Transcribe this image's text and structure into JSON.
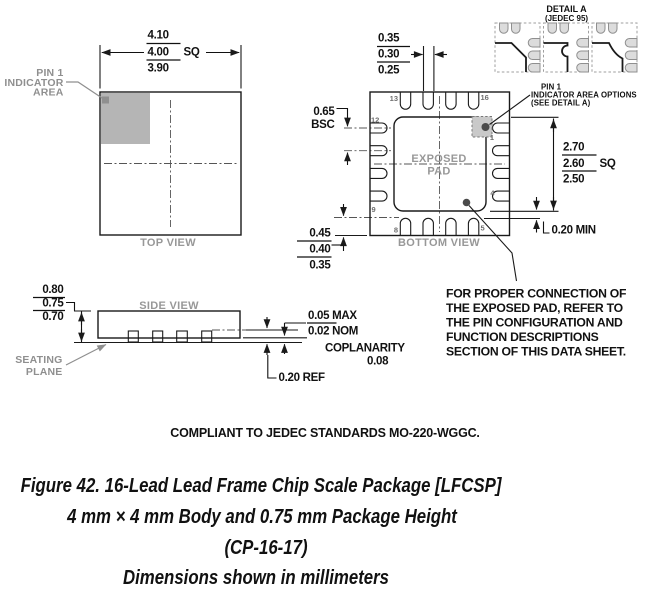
{
  "colors": {
    "ink": "#1a1a1a",
    "gray_label": "#989898",
    "pin1_area_fill": "#b5b5b5",
    "detail_pad_fill": "#dcdcdc",
    "stipple_fill": "#c9c9c9"
  },
  "top_view": {
    "title": "TOP VIEW",
    "pin1_label": [
      "PIN 1",
      "INDICATOR",
      "AREA"
    ],
    "body_dim": {
      "max": "4.10",
      "nom": "4.00",
      "suffix": "SQ",
      "min": "3.90"
    }
  },
  "bottom_view": {
    "title": "BOTTOM VIEW",
    "exposed_pad_label": [
      "EXPOSED",
      "PAD"
    ],
    "pins": {
      "top_left": "13",
      "top_right": "16",
      "left_top": "12",
      "left_bottom": "9",
      "bottom_left": "8",
      "bottom_right": "5",
      "right_top": "1",
      "right_bottom": "4"
    },
    "lead_width": {
      "max": "0.35",
      "nom": "0.30",
      "min": "0.25"
    },
    "pitch": {
      "value": "0.65",
      "qual": "BSC"
    },
    "lead_length": {
      "max": "0.45",
      "nom": "0.40",
      "min": "0.35"
    },
    "pad_dim": {
      "max": "2.70",
      "nom": "2.60",
      "suffix": "SQ",
      "min": "2.50"
    },
    "clearance": "0.20 MIN",
    "pin1_callout": [
      "PIN 1",
      "INDICATOR AREA OPTIONS",
      "(SEE DETAIL A)"
    ]
  },
  "detail_a": {
    "title": "DETAIL A",
    "subtitle": "(JEDEC 95)"
  },
  "side_view": {
    "title": "SIDE VIEW",
    "height": {
      "max": "0.80",
      "nom": "0.75",
      "min": "0.70"
    },
    "seating_plane": [
      "SEATING",
      "PLANE"
    ],
    "standoff": {
      "max": "0.05 MAX",
      "nom": "0.02 NOM"
    },
    "coplanarity": {
      "label": "COPLANARITY",
      "value": "0.08"
    },
    "lead_thickness": "0.20 REF"
  },
  "note_lines": [
    "FOR PROPER CONNECTION OF",
    "THE EXPOSED PAD, REFER TO",
    "THE PIN CONFIGURATION AND",
    "FUNCTION DESCRIPTIONS",
    "SECTION OF THIS DATA SHEET."
  ],
  "compliance": "COMPLIANT TO JEDEC STANDARDS MO-220-WGGC.",
  "caption": [
    "Figure 42. 16-Lead Lead Frame Chip Scale Package [LFCSP]",
    "4 mm × 4 mm Body and 0.75 mm Package Height",
    "(CP-16-17)",
    "Dimensions shown in millimeters"
  ]
}
